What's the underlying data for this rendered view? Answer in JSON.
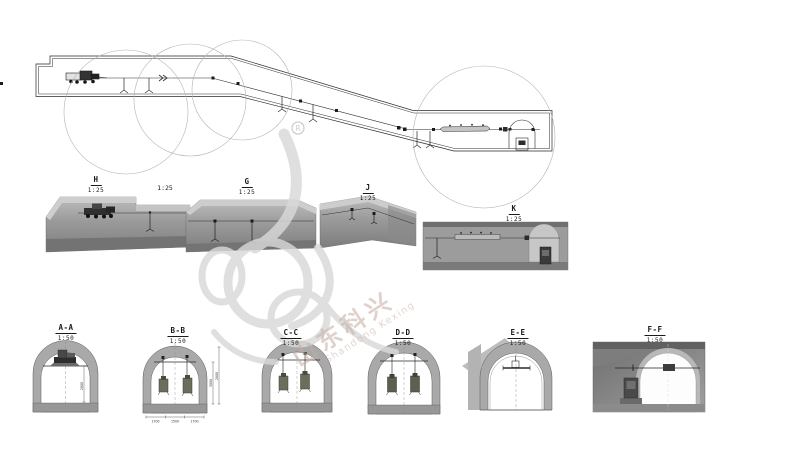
{
  "watermark": {
    "cn": "山东科兴",
    "en": "Shandong Kexing",
    "registered": "R"
  },
  "detail_views": {
    "h": {
      "id": "H",
      "scale": "1:25"
    },
    "g": {
      "id": "G",
      "scale": "1:25"
    },
    "j": {
      "id": "J",
      "scale": "1:25"
    },
    "k": {
      "id": "K",
      "scale": "1:25"
    },
    "extra_scale": "1:25"
  },
  "cross_sections": {
    "aa": {
      "id": "A-A",
      "scale": "1:50",
      "dim_right": "2800"
    },
    "bb": {
      "id": "B-B",
      "scale": "1:50",
      "dims_right": [
        "3000",
        "2800"
      ],
      "dims_bottom": [
        "1700",
        "1500",
        "1700"
      ]
    },
    "cc": {
      "id": "C-C",
      "scale": "1:50"
    },
    "dd": {
      "id": "D-D",
      "scale": "1:50"
    },
    "ee": {
      "id": "E-E",
      "scale": "1:50"
    },
    "ff": {
      "id": "F-F",
      "scale": "1:50"
    }
  }
}
